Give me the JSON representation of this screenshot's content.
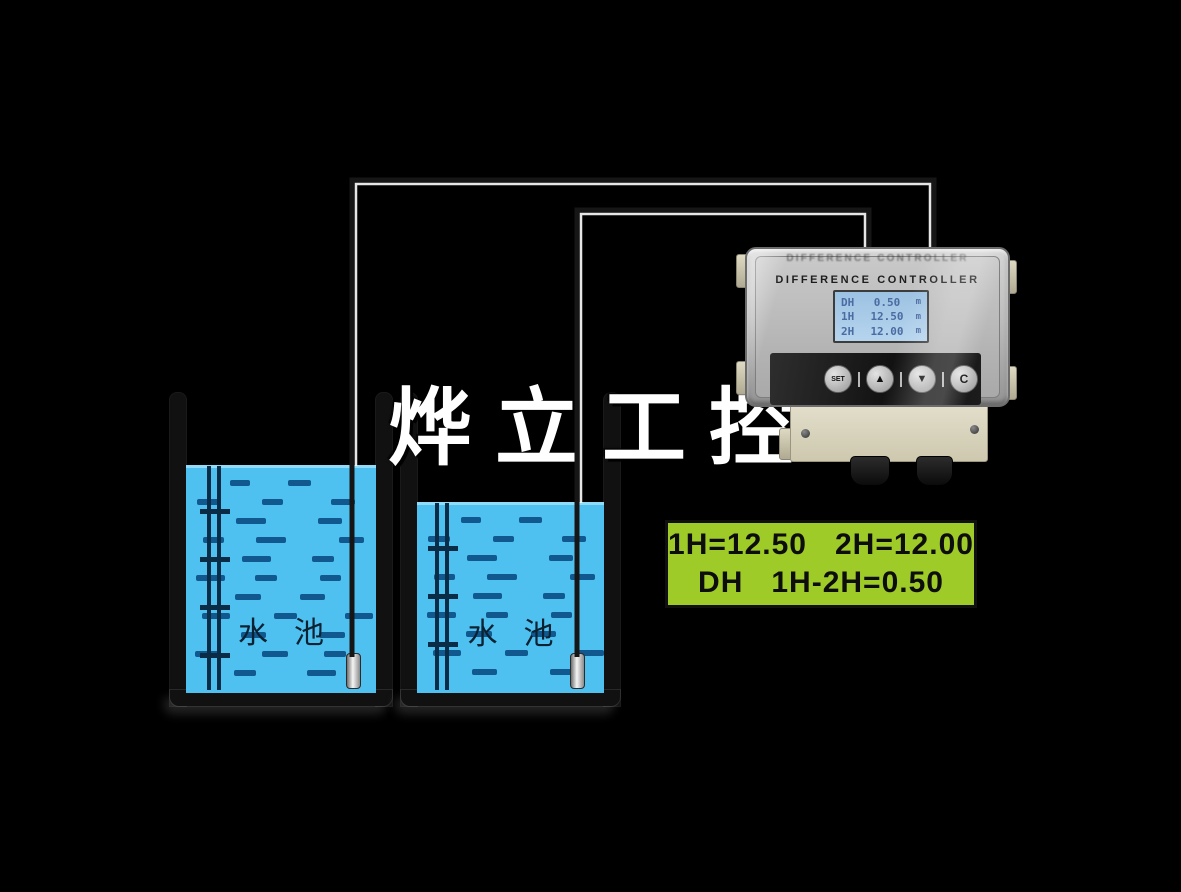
{
  "scene": {
    "background_color": "#000000",
    "watermark_text": "烨立工控"
  },
  "tanks": {
    "water_color": "#4ec1f0",
    "wave_dash_color": "#11588f",
    "tank1": {
      "label": "水池"
    },
    "tank2": {
      "label": "水池"
    }
  },
  "controller": {
    "reflection_title": "DIFFERENCE CONTROLLER",
    "title": "DIFFERENCE CONTROLLER",
    "lcd": {
      "bg_color": "#a9cbe8",
      "text_color": "#4a6ca2",
      "rows": [
        {
          "label": "DH",
          "value": "0.50",
          "unit": "m"
        },
        {
          "label": "1H",
          "value": "12.50",
          "unit": "m"
        },
        {
          "label": "2H",
          "value": "12.00",
          "unit": "m"
        }
      ]
    },
    "buttons": [
      {
        "label": "SET"
      },
      {
        "label": "▲"
      },
      {
        "label": "▼"
      },
      {
        "label": "C"
      }
    ]
  },
  "readout": {
    "bg_color": "#9ecb28",
    "line1": "1H=12.50   2H=12.00",
    "line2": "DH   1H-2H=0.50"
  }
}
